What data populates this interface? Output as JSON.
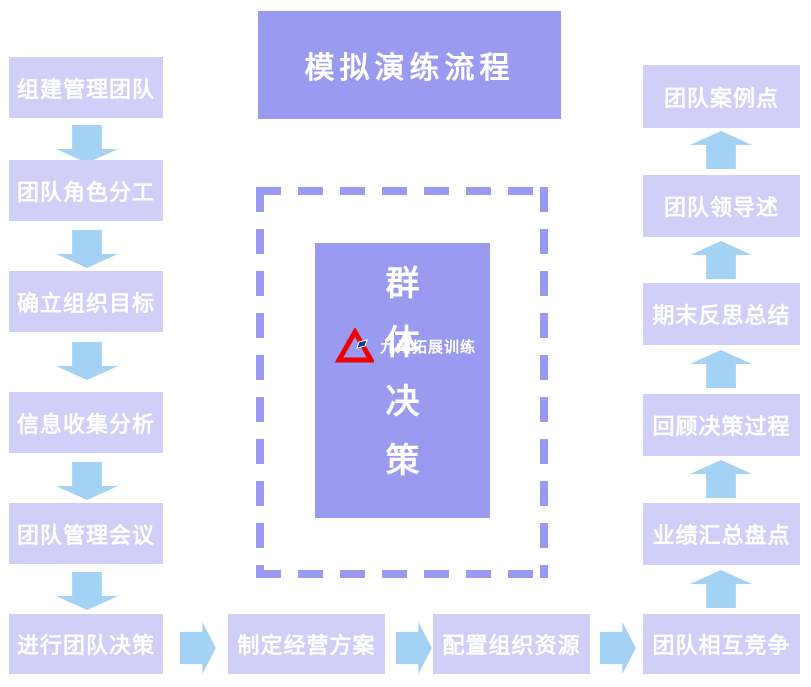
{
  "title": "模拟演练流程",
  "flow": {
    "left_column": [
      "组建管理团队",
      "团队角色分工",
      "确立组织目标",
      "信息收集分析",
      "团队管理会议",
      "进行团队决策"
    ],
    "bottom_row": [
      "制定经营方案",
      "配置组织资源"
    ],
    "right_column": [
      "团队案例点",
      "团队领导述",
      "期末反思总结",
      "回顾决策过程",
      "业绩汇总盘点",
      "团队相互竞争"
    ]
  },
  "center": {
    "vertical_text": [
      "群",
      "体",
      "决",
      "策"
    ],
    "logo_text": "九州拓展训练"
  },
  "colors": {
    "light_box": "#cfcff7",
    "dark_box": "#9a9af0",
    "arrow": "#a3d2f5",
    "dashed_border": "#9a9af2",
    "logo_red": "#ee0000",
    "logo_blue": "#003388",
    "text": "#ffffff"
  }
}
